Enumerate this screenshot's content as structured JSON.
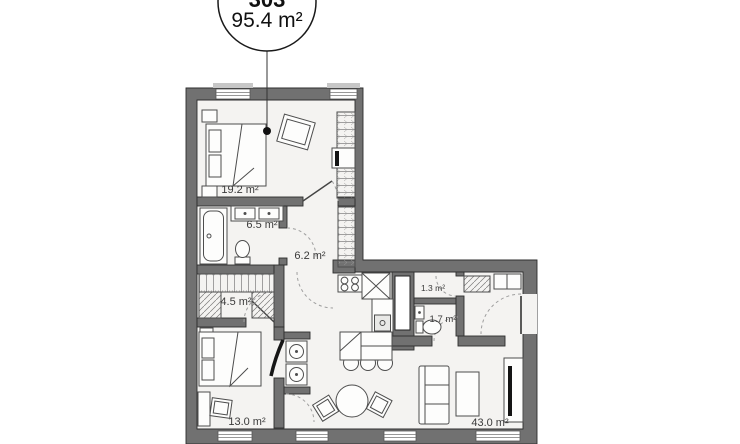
{
  "callout": {
    "unit_number": "303",
    "area": "95.4 m²"
  },
  "rooms": [
    {
      "name": "bedroom-1",
      "area": "19.2 m²"
    },
    {
      "name": "bathroom",
      "area": "6.5 m²"
    },
    {
      "name": "hallway",
      "area": "6.2 m²"
    },
    {
      "name": "walk-in-closet",
      "area": "4.5 m²"
    },
    {
      "name": "bedroom-2",
      "area": "13.0 m²"
    },
    {
      "name": "storage",
      "area": "1.3 m²"
    },
    {
      "name": "wc",
      "area": "1.7 m²"
    },
    {
      "name": "living-kitchen",
      "area": "43.0 m²"
    }
  ],
  "colors": {
    "wall": "#717171",
    "floor": "#f4f3f1",
    "background": "#ffffff",
    "line": "#4d4d4d"
  }
}
